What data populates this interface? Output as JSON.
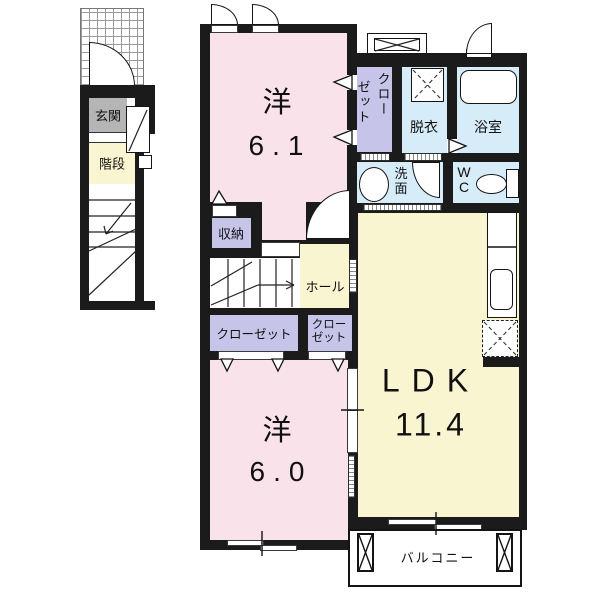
{
  "plan_title": "2LDK apartment floor plan",
  "first_floor": {
    "entrance_label": "玄関",
    "stairs_label": "階段"
  },
  "second_floor": {
    "bedroom1": {
      "name": "洋",
      "area": "6.1"
    },
    "closet_upper": {
      "col_right": "クロー",
      "col_left": "ゼット"
    },
    "dressing_room": {
      "label": "脱衣"
    },
    "bathroom": {
      "label": "浴室"
    },
    "washroom": {
      "line1": "洗",
      "line2": "面"
    },
    "toilet": {
      "line1": "W",
      "line2": "C"
    },
    "storage": {
      "label": "収納"
    },
    "hall": {
      "label": "ホール"
    },
    "closet_a": {
      "label": "クローゼット"
    },
    "closet_b": {
      "line1": "クロー",
      "line2": "ゼット"
    },
    "bedroom2": {
      "name": "洋",
      "area": "6.0"
    },
    "ldk": {
      "name": "LDK",
      "area": "11.4"
    },
    "balcony": {
      "label": "バルコニー"
    }
  },
  "icons": {
    "bathtub": "bathtub-icon",
    "washing_machine_space": "washing-machine-space-icon",
    "washbasin": "washbasin-icon",
    "toilet_bowl": "toilet-icon",
    "kitchen_counter": "kitchen-counter-icon",
    "refrigerator_space": "refrigerator-space-icon",
    "meter_box": "meter-box-icon",
    "stairs_up_arrow": "stairs-arrow-icon",
    "door_swing": "door-swing-icon",
    "balcony_column": "balcony-column-icon"
  },
  "colors": {
    "wall": "#1b1b1b",
    "bedroom_pink": "#f9e2ea",
    "ldk_yellow": "#faf5d1",
    "wet_area_blue": "#d6ecf8",
    "closet_lavender": "#c7c4e9",
    "entrance_gray": "#b5b5b5"
  }
}
